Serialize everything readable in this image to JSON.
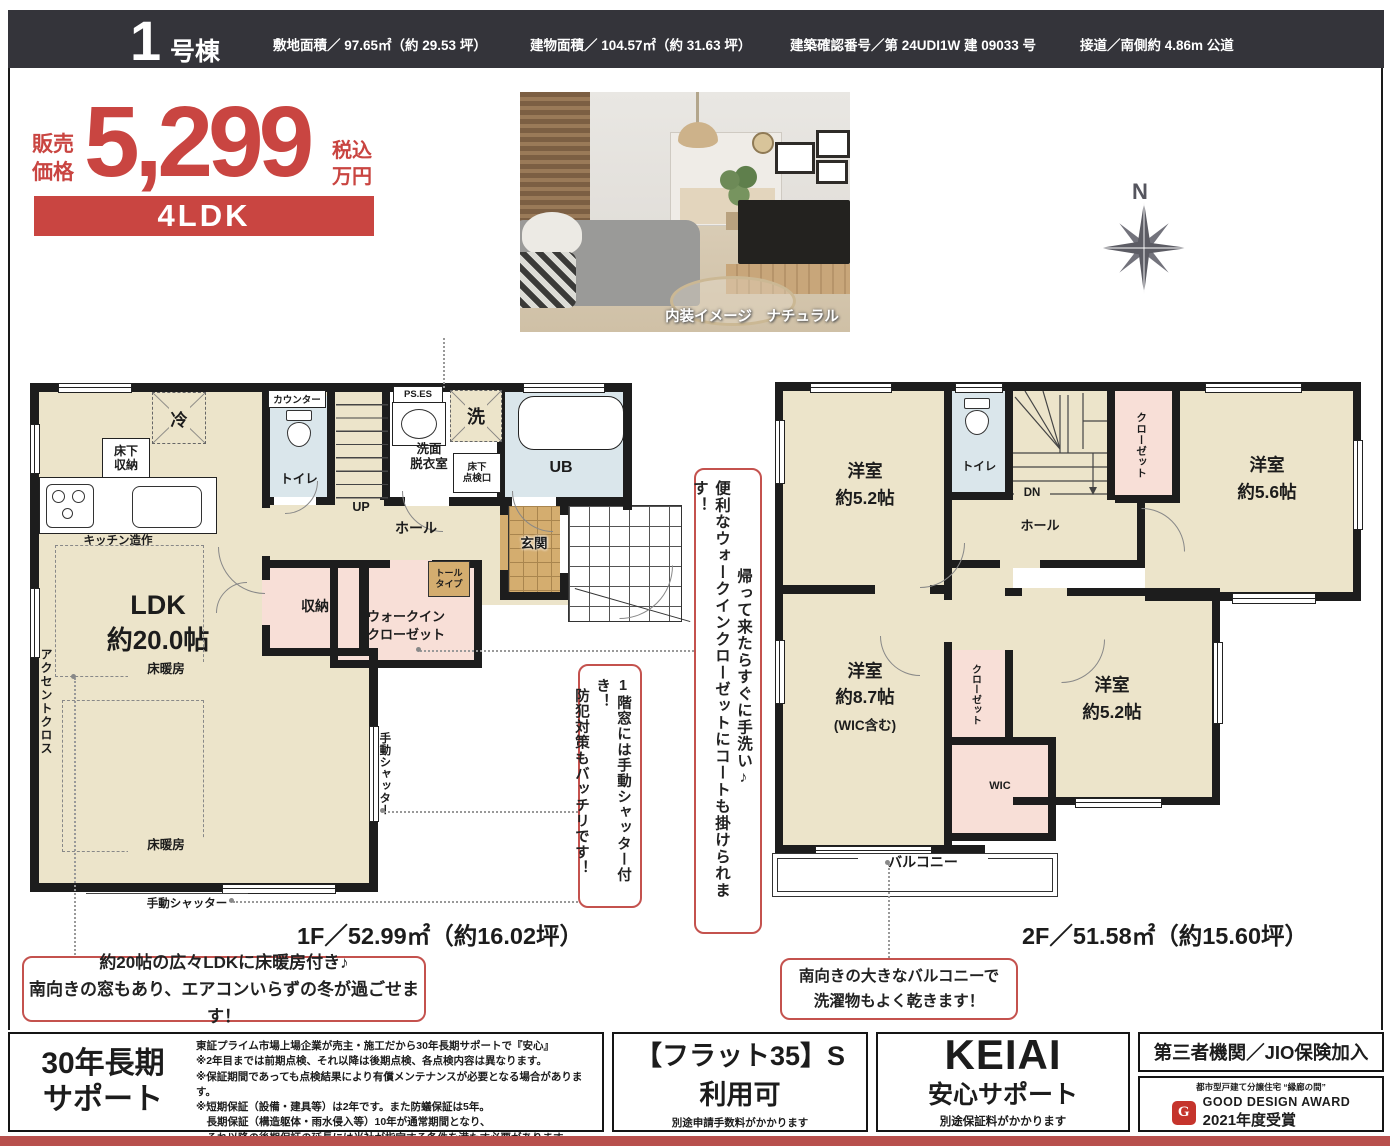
{
  "header": {
    "unit_big": "1",
    "unit_small": "号棟",
    "spec_1": "敷地面積／ 97.65㎡（約 29.53 坪）",
    "spec_2": "建物面積／ 104.57㎡（約 31.63 坪）",
    "spec_3": "建築確認番号／第 24UDI1W 建 09033 号",
    "spec_4": "接道／南側約 4.86m 公道"
  },
  "price": {
    "sale_1": "販売",
    "sale_2": "価格",
    "amount": "5,299",
    "tax_1": "税込",
    "tax_2": "万円",
    "plan": "4LDK"
  },
  "photo": {
    "caption": "内装イメージ　ナチュラル"
  },
  "compass": {
    "north": "N"
  },
  "floor1": {
    "title": "1F／52.99㎡（約16.02坪）",
    "labels": {
      "counter": "カウンター",
      "toilet": "トイレ",
      "up": "UP",
      "ps_es": "PS.ES",
      "fridge": "冷",
      "washer": "洗",
      "underfloor_1": "床下",
      "underfloor_2": "収納",
      "kitchen": "キッチン造作",
      "washroom_1": "洗面",
      "washroom_2": "脱衣室",
      "hatch_1": "床下",
      "hatch_2": "点検口",
      "ub": "UB",
      "hall": "ホール",
      "genkan": "玄関",
      "tall_1": "トール",
      "tall_2": "タイプ",
      "storage": "収納",
      "wic_1": "ウォークイン",
      "wic_2": "クローゼット",
      "ldk_1": "LDK",
      "ldk_2": "約20.0帖",
      "accent_cross": "アクセントクロス",
      "floor_heating": "床暖房",
      "shutter": "手動シャッター"
    }
  },
  "floor2": {
    "title": "2F／51.58㎡（約15.60坪）",
    "labels": {
      "toilet": "トイレ",
      "dn": "DN",
      "hall": "ホール",
      "closet": "クローゼット",
      "r52a_1": "洋室",
      "r52a_2": "約5.2帖",
      "r56_1": "洋室",
      "r56_2": "約5.6帖",
      "r87_1": "洋室",
      "r87_2": "約8.7帖",
      "r87_3": "(WIC含む)",
      "r52b_1": "洋室",
      "r52b_2": "約5.2帖",
      "wic": "WIC",
      "balcony": "バルコニー"
    }
  },
  "callouts": {
    "wic_note_col1": "帰って来たらすぐに手洗い♪",
    "wic_note_col2": "便利なウォークインクローゼットにコートも掛けられます！",
    "shutter_note_col1": "1階窓には手動シャッター付き！",
    "shutter_note_col2": "防犯対策もバッチリです！",
    "ldk_note_1": "約20帖の広々LDKに床暖房付き♪",
    "ldk_note_2": "南向きの窓もあり、エアコンいらずの冬が過ごせます！",
    "balcony_note_1": "南向きの大きなバルコニーで",
    "balcony_note_2": "洗濯物もよく乾きます！"
  },
  "footer": {
    "support": {
      "title_1": "30年長期",
      "title_2": "サポート",
      "notes": [
        "東証プライム市場上場企業が売主・施工だから30年長期サポートで『安心』",
        "※2年目までは前期点検、それ以降は後期点検、各点検内容は異なります。",
        "※保証期間であっても点検結果により有償メンテナンスが必要となる場合があります。",
        "※短期保証（設備・建具等）は2年です。また防蟻保証は5年。",
        "　長期保証（構造躯体・雨水侵入等）10年が通常期間となり、",
        "　それ以降の後期保証の延長には当社が指定する条件を満たす必要があります。"
      ]
    },
    "flat35": {
      "title_1": "【フラット35】S",
      "title_2": "利用可",
      "note": "別途申請手数料がかかります"
    },
    "keiai": {
      "brand": "KEIAI",
      "title": "安心サポート",
      "note": "別途保証料がかかります"
    },
    "jio": {
      "title": "第三者機関／JIO保険加入",
      "award_tag": "都市型戸建て分譲住宅 “縁廊の間”",
      "award_name": "GOOD DESIGN AWARD",
      "award_year": "2021年度受賞",
      "gmark": "G"
    }
  },
  "colors": {
    "accent_red": "#c94541",
    "badge_red": "#c94541",
    "bottom_bar_red": "#b8504d",
    "header_bar": "#34343a",
    "room_cream": "#ece4ca",
    "room_pink": "#f8dfd7",
    "room_blue": "#dae6eb",
    "room_tan": "#d4ad6f",
    "wall_black": "#1d1d1d"
  }
}
